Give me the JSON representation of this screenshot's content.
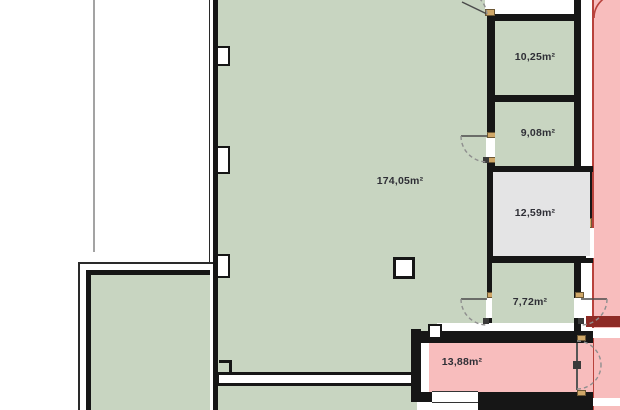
{
  "rooms": {
    "living": {
      "area_label": "174,05m²"
    },
    "top_small": {
      "area_label": "10,25m²"
    },
    "mid_small": {
      "area_label": "9,08m²"
    },
    "gray_room": {
      "area_label": "12,59m²"
    },
    "lower_small": {
      "area_label": "7,72m²"
    },
    "pink_room": {
      "area_label": "13,88m²"
    }
  },
  "palette": {
    "room_green": "#c8d5c1",
    "zone_pink": "#f8bdbd",
    "zone_pink_border": "#b8423c",
    "zone_dark_red": "#8e2b26",
    "room_gray": "#e4e4e5",
    "wall_black": "#161616",
    "door_jamb_tan": "#cfa768",
    "door_arc_gray": "#8f8f8f",
    "guide_gray": "#a3a3a3",
    "label_color": "#2f2f36"
  }
}
